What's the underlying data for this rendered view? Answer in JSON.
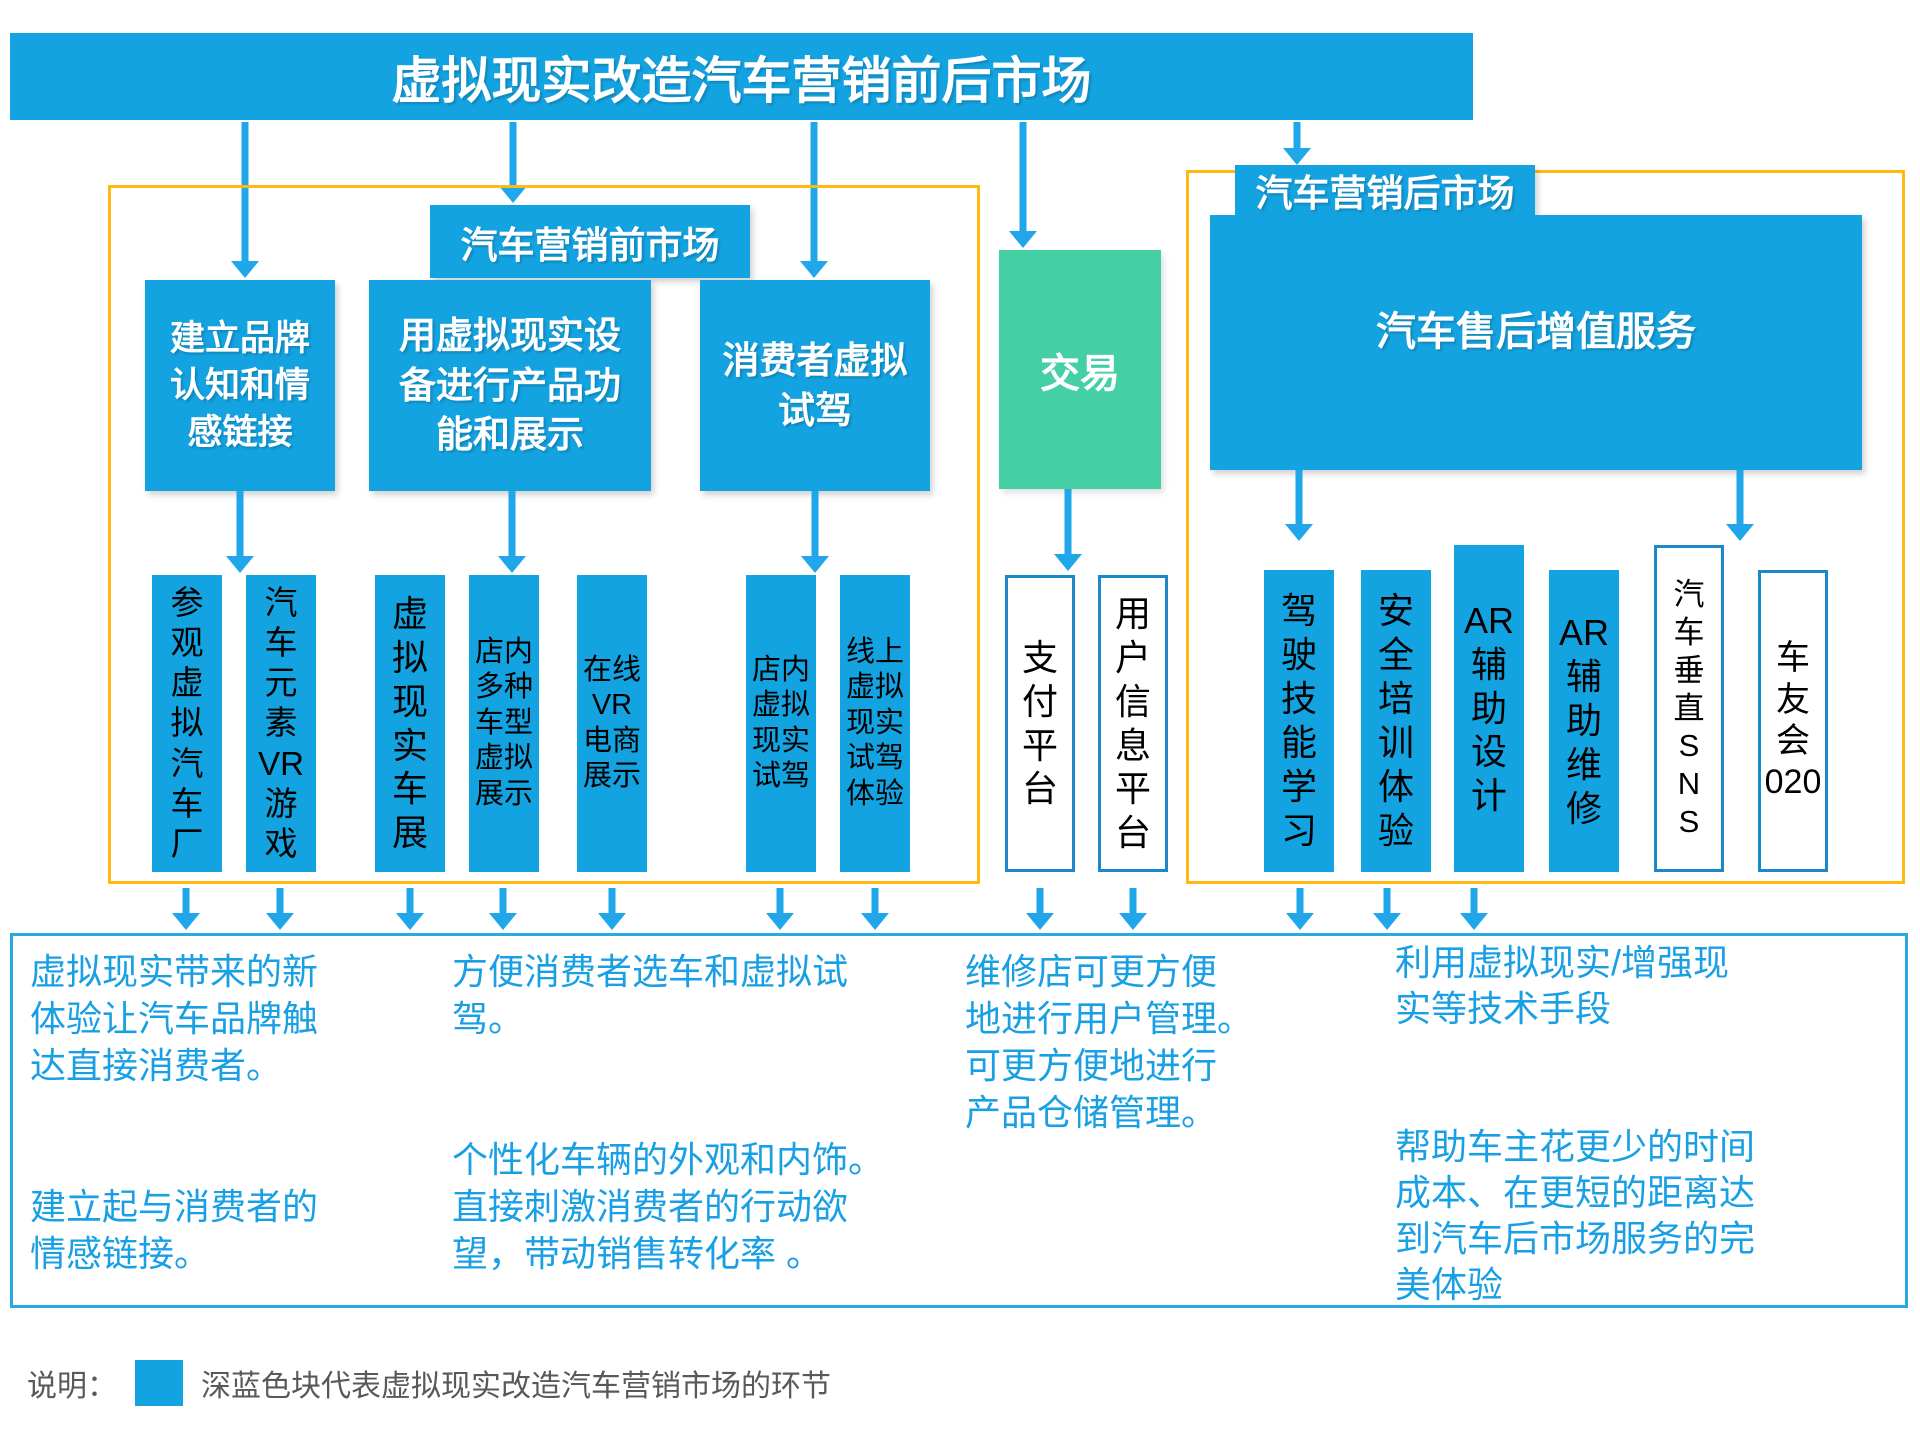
{
  "title": "虚拟现实改造汽车营销前后市场",
  "colors": {
    "box_blue": "#14A3E1",
    "transaction_green": "#45CFA4",
    "section_border_orange": "#FEB913",
    "note_text_blue": "#189FE4",
    "white_item_border_blue": "#1C87C9",
    "legend_text_gray": "#58595B"
  },
  "pre_market": {
    "header": "汽车营销前市场",
    "boxes": [
      {
        "label": "建立品牌认知和情感链接",
        "display": "建立品牌\n认知和情\n感链接"
      },
      {
        "label": "用虚拟现实设备进行产品功能和展示",
        "display": "用虚拟现实设\n备进行产品功\n能和展示"
      },
      {
        "label": "消费者虚拟试驾",
        "display": "消费者虚拟\n试驾"
      }
    ],
    "items": [
      {
        "label": "参观虚拟汽车厂",
        "display": "参\n观\n虚\n拟\n汽\n车\n厂"
      },
      {
        "label": "汽车元素VR游戏",
        "display": "汽\n车\n元\n素\nVR\n游\n戏"
      },
      {
        "label": "虚拟现实车展",
        "display": "虚\n拟\n现\n实\n车\n展"
      },
      {
        "label": "店内多种车型虚拟展示",
        "display": "店内\n多种\n车型\n虚拟\n展示"
      },
      {
        "label": "在线VR电商展示",
        "display": "在线\nVR\n电商\n展示"
      },
      {
        "label": "店内虚拟现实试驾",
        "display": "店内\n虚拟\n现实\n试驾"
      },
      {
        "label": "线上虚拟现实试驾体验",
        "display": "线上\n虚拟\n现实\n试驾\n体验"
      }
    ],
    "note_brand": "虚拟现实带来的新\n体验让汽车品牌触\n达直接消费者。\n\n\n建立起与消费者的\n情感链接。",
    "note_select": "方便消费者选车和虚拟试\n驾。\n\n\n个性化车辆的外观和内饰。\n直接刺激消费者的行动欲\n望，带动销售转化率 。"
  },
  "transaction": {
    "label": "交易",
    "items": [
      {
        "label": "支付平台",
        "display": "支\n付\n平\n台"
      },
      {
        "label": "用户信息平台",
        "display": "用\n户\n信\n息\n平\n台"
      }
    ],
    "note": "维修店可更方便\n地进行用户管理。\n可更方便地进行\n产品仓储管理。"
  },
  "post_market": {
    "header": "汽车营销后市场",
    "main_box": "汽车售后增值服务",
    "items": [
      {
        "label": "驾驶技能学习",
        "display": "驾\n驶\n技\n能\n学\n习",
        "style": "blue"
      },
      {
        "label": "安全培训体验",
        "display": "安\n全\n培\n训\n体\n验",
        "style": "blue"
      },
      {
        "label": "AR辅助设计",
        "display": "AR\n辅\n助\n设\n计",
        "style": "blue"
      },
      {
        "label": "AR辅助维修",
        "display": "AR\n辅\n助\n维\n修",
        "style": "blue"
      },
      {
        "label": "汽车垂直SNS",
        "display": "汽\n车\n垂\n直\nS\nN\nS",
        "style": "white"
      },
      {
        "label": "车友会020",
        "display": "车\n友\n会\n020",
        "style": "white"
      }
    ],
    "note": "利用虚拟现实/增强现\n实等技术手段\n\n\n帮助车主花更少的时间\n成本、在更短的距离达\n到汽车后市场服务的完\n美体验"
  },
  "legend": {
    "prefix": "说明：",
    "label": "深蓝色块代表虚拟现实改造汽车营销市场的环节"
  }
}
